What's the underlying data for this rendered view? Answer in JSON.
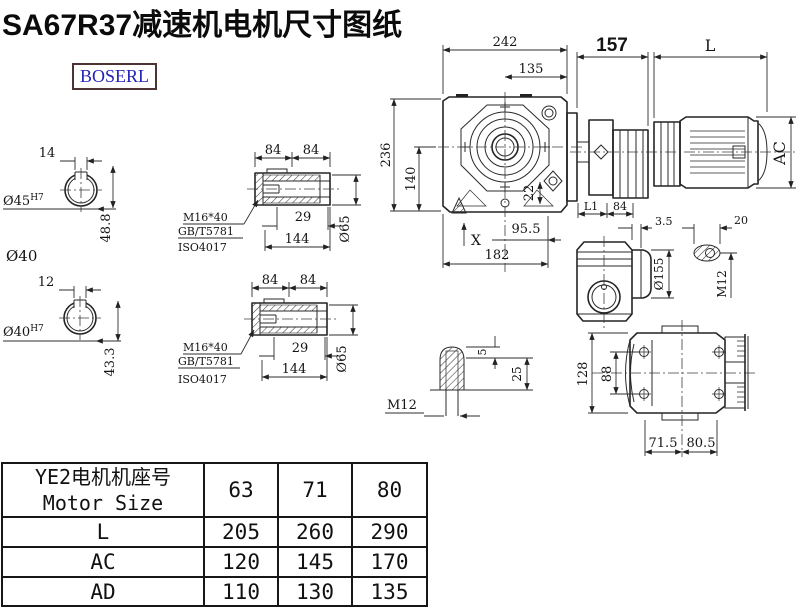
{
  "page": {
    "title": "SA67R37减速机电机尺寸图纸",
    "logo": "BOSERL"
  },
  "dims": {
    "front": {
      "w242": "242",
      "w135": "135",
      "h236": "236",
      "h140": "140",
      "v22": "22",
      "w95_5": "95.5",
      "x_mark": "X",
      "w182": "182"
    },
    "assembly": {
      "w157": "157",
      "wL": "L",
      "hAC": "AC",
      "l1": "L1",
      "w84": "84"
    },
    "shaft_top": {
      "key": "14",
      "bore": "Ø45",
      "tol": "H7",
      "depth": "48.8",
      "extra": "Ø40"
    },
    "shaft_bottom": {
      "key": "12",
      "bore": "Ø40",
      "tol": "H7",
      "depth": "43.3"
    },
    "hollow_top": {
      "w84a": "84",
      "w84b": "84",
      "bolt": "M16*40",
      "std1": "GB/T5781",
      "std2": "ISO4017",
      "w29": "29",
      "w144": "144",
      "dia": "Ø65"
    },
    "hollow_bottom": {
      "w84a": "84",
      "w84b": "84",
      "bolt": "M16*40",
      "std1": "GB/T5781",
      "std2": "ISO4017",
      "w29": "29",
      "w144": "144",
      "dia": "Ø65"
    },
    "side": {
      "dia": "Ø155",
      "gap": "3.5",
      "w20": "20",
      "thread": "M12"
    },
    "plug": {
      "thread": "M12",
      "h5": "5",
      "h25": "25"
    },
    "bottom": {
      "h128": "128",
      "h88": "88",
      "w71_5": "71.5",
      "w80_5": "80.5"
    }
  },
  "table": {
    "header_cn": "YE2电机机座号",
    "header_en": "Motor Size",
    "columns": [
      "63",
      "71",
      "80"
    ],
    "rows": [
      {
        "label": "L",
        "values": [
          "205",
          "260",
          "290"
        ]
      },
      {
        "label": "AC",
        "values": [
          "120",
          "145",
          "170"
        ]
      },
      {
        "label": "AD",
        "values": [
          "110",
          "130",
          "135"
        ]
      }
    ]
  }
}
